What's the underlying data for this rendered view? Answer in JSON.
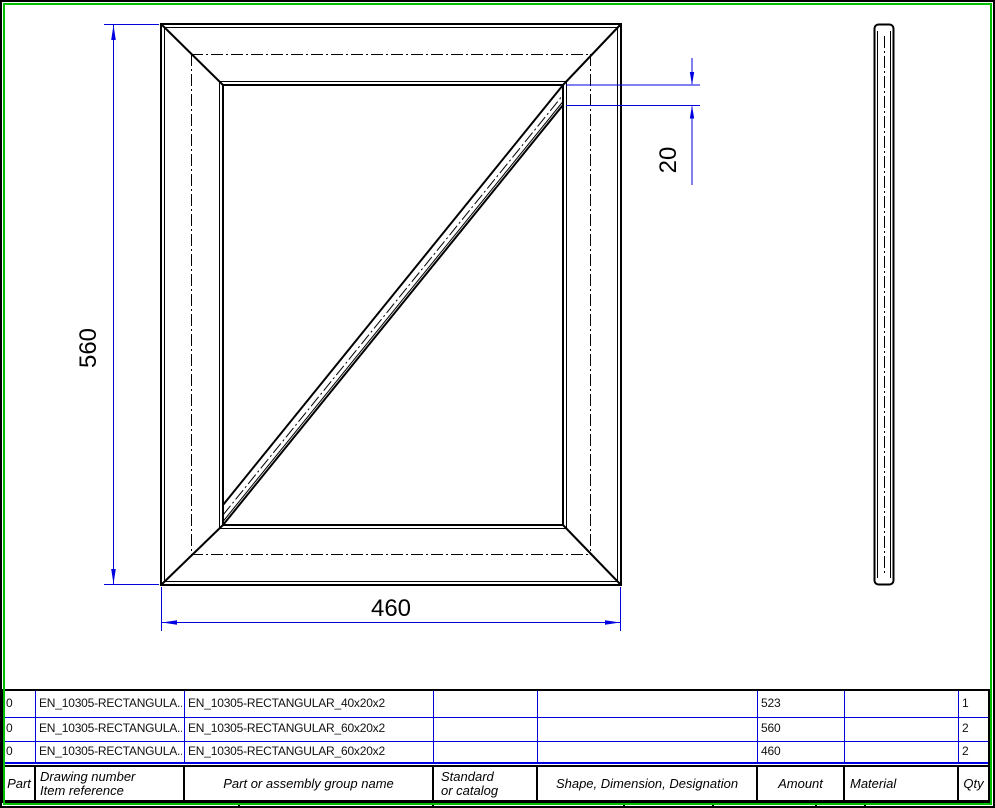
{
  "sheet": {
    "type_label": "technical-drawing-sheet"
  },
  "dimensions": {
    "height": "560",
    "width": "460",
    "brace_offset": "20"
  },
  "bom": {
    "headers": {
      "part": "Part",
      "drawing_number_line1": "Drawing number",
      "drawing_number_line2": "Item reference",
      "group_name": "Part or assembly group name",
      "standard_line1": "Standard",
      "standard_line2": "or catalog",
      "shape": "Shape, Dimension, Designation",
      "amount": "Amount",
      "material": "Material",
      "qty": "Qty"
    },
    "rows": [
      {
        "part": "0",
        "drawing_number": "EN_10305-RECTANGULA...",
        "group_name": "EN_10305-RECTANGULAR_40x20x2",
        "standard": "",
        "shape": "",
        "amount": "523",
        "material": "",
        "qty": "1"
      },
      {
        "part": "0",
        "drawing_number": "EN_10305-RECTANGULA...",
        "group_name": "EN_10305-RECTANGULAR_60x20x2",
        "standard": "",
        "shape": "",
        "amount": "560",
        "material": "",
        "qty": "2"
      },
      {
        "part": "0",
        "drawing_number": "EN_10305-RECTANGULA...",
        "group_name": "EN_10305-RECTANGULAR_60x20x2",
        "standard": "",
        "shape": "",
        "amount": "460",
        "material": "",
        "qty": "2"
      }
    ]
  },
  "colors": {
    "dimension_blue": "#0000e1",
    "table_line_blue": "#0000e1",
    "sheet_green": "#00be00",
    "geometry_black": "#000000"
  }
}
